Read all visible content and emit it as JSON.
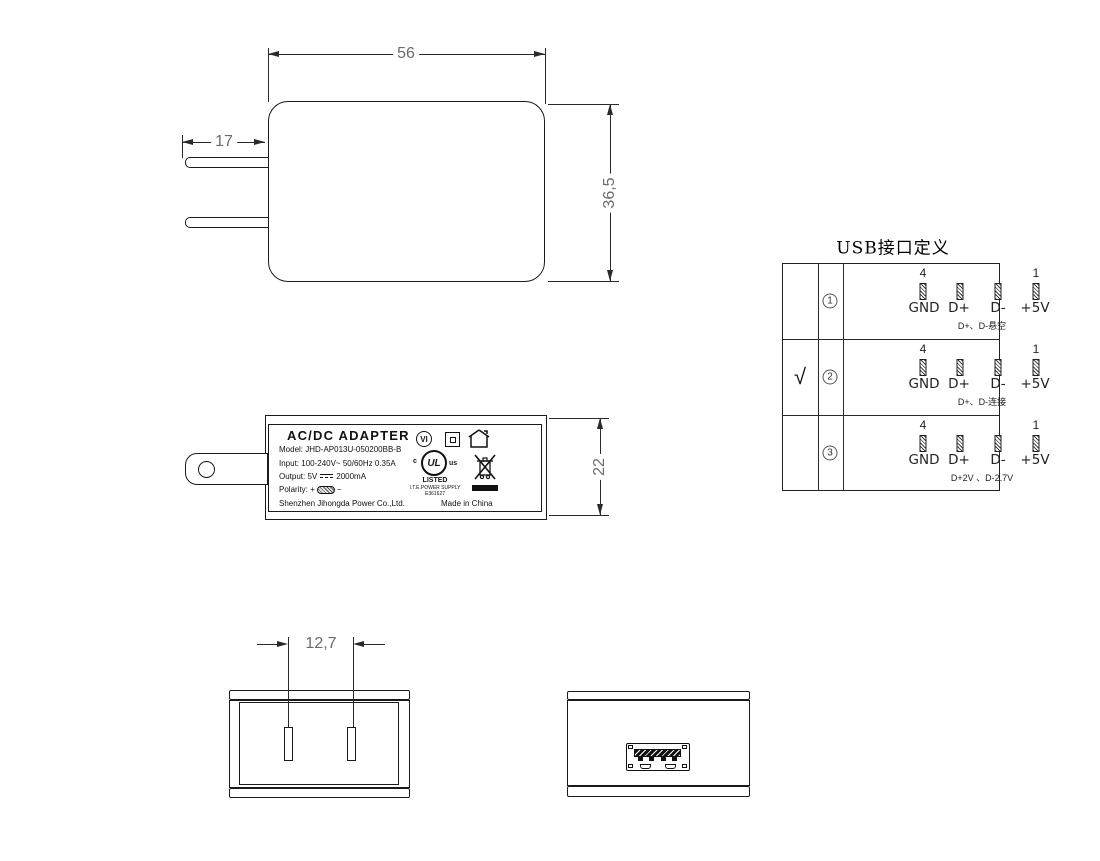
{
  "colors": {
    "line": "#1a1a1a",
    "dim_text": "#6b6b6b"
  },
  "front_view": {
    "dim_width": "56",
    "dim_pin_length": "17",
    "dim_height": "36,5"
  },
  "side_view": {
    "dim_height": "22",
    "label": {
      "title": "AC/DC  ADAPTER",
      "model": "Model: JHD-AP013U-050200BB-B",
      "input": "Input: 100-240V~  50/60Hz  0.35A",
      "output_prefix": "Output: 5V",
      "output_suffix": "2000mA",
      "polarity_label": "Polarity:",
      "polarity_plus": "+",
      "polarity_minus": "−",
      "manufacturer": "Shenzhen Jihongda Power Co.,Ltd.",
      "made_in": "Made in China",
      "efficiency_mark": "VI",
      "ul_c": "c",
      "ul_us": "us",
      "ul_letters": "UL",
      "ul_listed": "LISTED",
      "ul_supply": "I.T.E.POWER SUPPLY",
      "ul_file": "E361627"
    }
  },
  "usb_table": {
    "title": "USB接口定义",
    "pin_no_first": "4",
    "pin_no_last": "1",
    "pin_labels": [
      "GND",
      "D+",
      "D-",
      "+5V"
    ],
    "rows": [
      {
        "selected": "",
        "num": "1",
        "note": "D+、D-悬空"
      },
      {
        "selected": "√",
        "num": "2",
        "note": "D+、D-连接"
      },
      {
        "selected": "",
        "num": "3",
        "note": "D+2V 、D-2.7V"
      }
    ]
  },
  "bottom_views": {
    "dim_pin_spacing": "12,7"
  }
}
